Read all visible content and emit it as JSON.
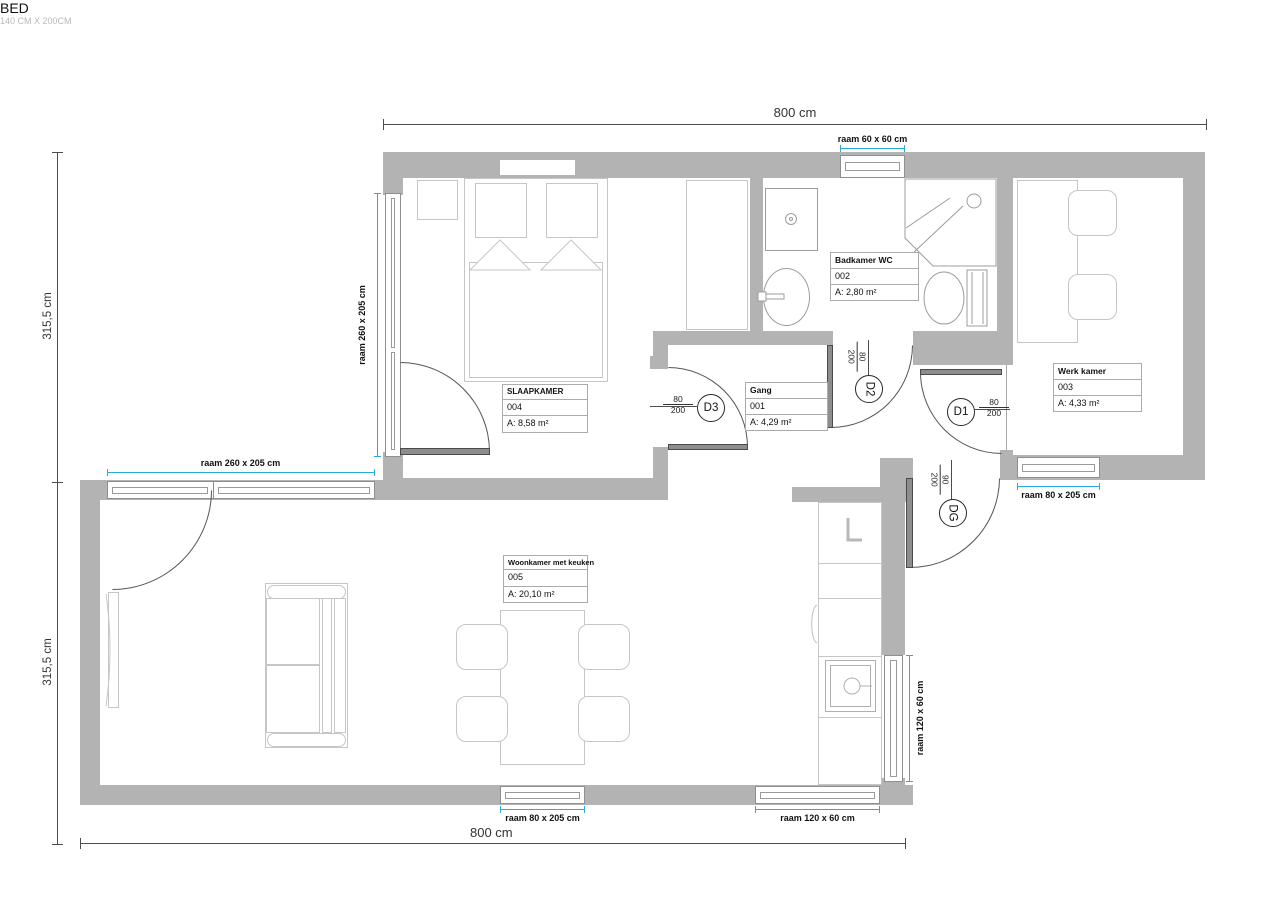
{
  "dimensions": {
    "top": "800 cm",
    "bottom": "800 cm",
    "left_upper": "315,5 cm",
    "left_lower": "315,5 cm"
  },
  "windows": {
    "bath_top": "raam 60 x 60 cm",
    "bedroom_left": "raam 260 x 205 cm",
    "livingroom_top": "raam 260 x 205 cm",
    "werkkamer_bottom": "raam 80 x 205 cm",
    "livingroom_bottom_left": "raam 80 x 205 cm",
    "livingroom_bottom_right": "raam 120 x 60 cm",
    "livingroom_right": "raam 120 x 60 cm"
  },
  "rooms": {
    "slaapkamer": {
      "name": "SLAAPKAMER",
      "number": "004",
      "area": "A: 8,58 m²"
    },
    "badkamer": {
      "name": "Badkamer WC",
      "number": "002",
      "area": "A: 2,80 m²"
    },
    "werkkamer": {
      "name": "Werk kamer",
      "number": "003",
      "area": "A: 4,33 m²"
    },
    "gang": {
      "name": "Gang",
      "number": "001",
      "area": "A: 4,29 m²"
    },
    "woonkamer": {
      "name": "Woonkamer met keuken",
      "number": "005",
      "area": "A: 20,10 m²"
    }
  },
  "bed": {
    "label": "BED",
    "size": "140 CM X 200CM"
  },
  "doors": {
    "d1": {
      "label": "D1",
      "width": "80",
      "height": "200"
    },
    "d2": {
      "label": "D2",
      "width": "80",
      "height": "200"
    },
    "d3": {
      "label": "D3",
      "width": "80",
      "height": "200"
    },
    "dg": {
      "label": "DG",
      "width": "90",
      "height": "200"
    }
  },
  "colors": {
    "wall": "#b3b3b3",
    "accent": "#29abe2"
  }
}
